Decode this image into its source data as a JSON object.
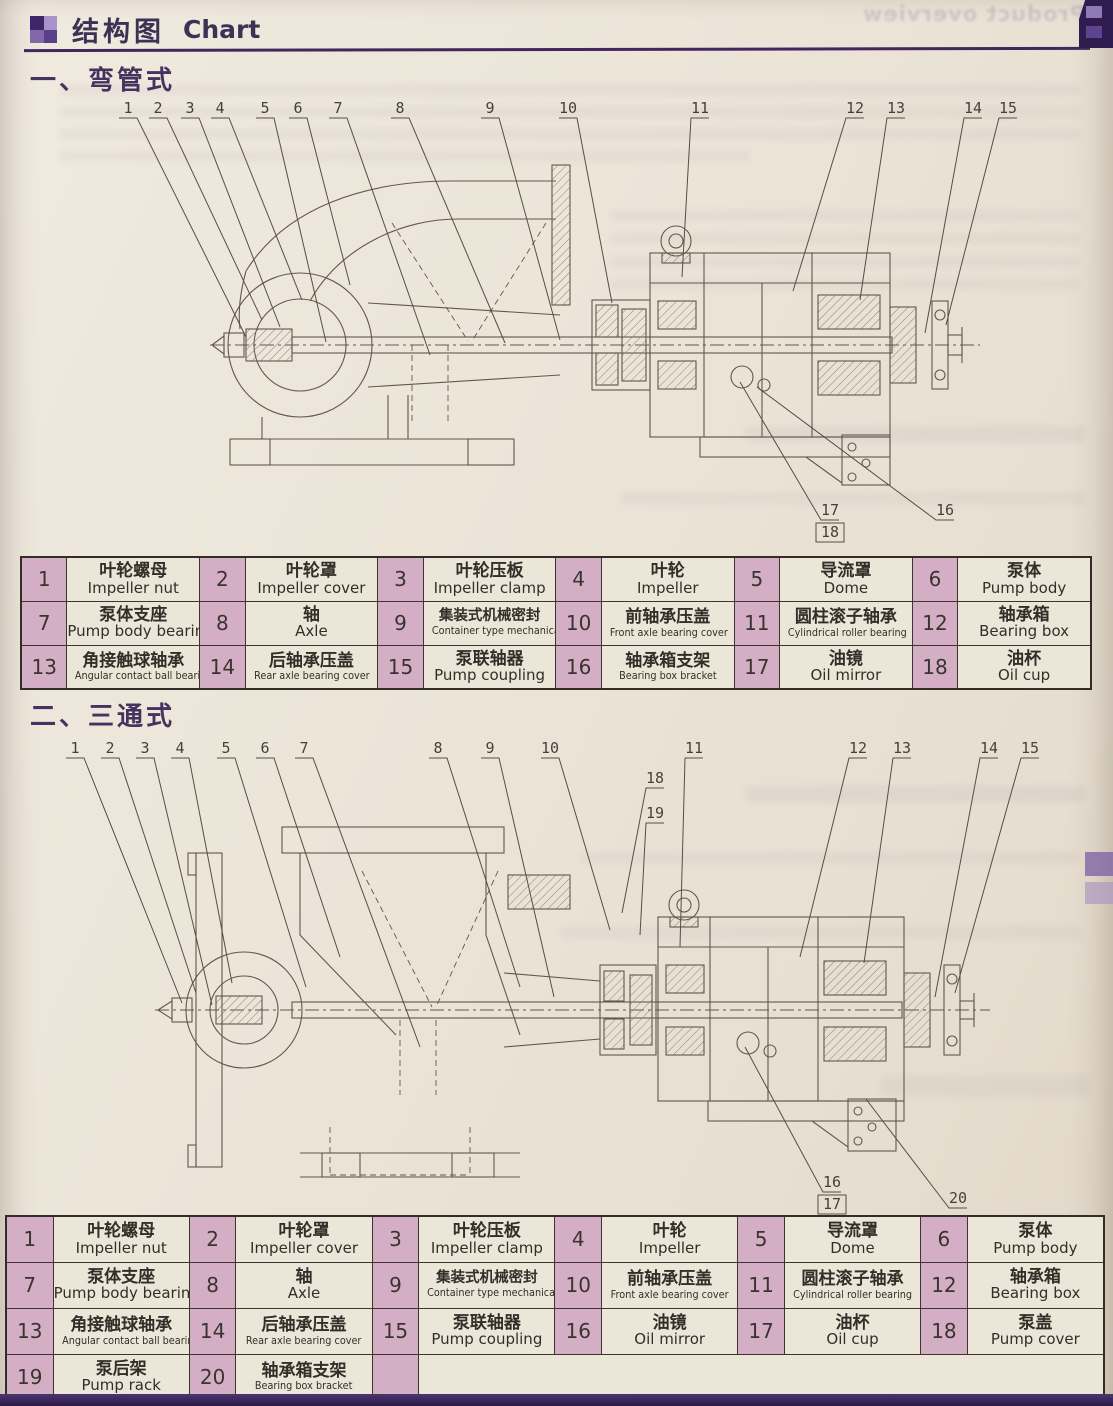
{
  "colors": {
    "heading_purple": "#46325f",
    "rule_purple": "#43265e",
    "table_number_cell_bg": "#d4aec5",
    "table_name_cell_bg": "#ece6d9",
    "table_border": "#3c362f",
    "page_background": "#eae3d6",
    "drawing_line": "#60584b",
    "page_edge_purple": "#33205a"
  },
  "header": {
    "title_zh": "结构图",
    "title_en": "Chart"
  },
  "sections": [
    {
      "heading": "一、弯管式"
    },
    {
      "heading": "二、三通式"
    }
  ],
  "bleedthrough": {
    "top_right": "Product overview"
  },
  "diagrams": [
    {
      "name": "bend-pipe-type-pump-cross-section",
      "callouts": [
        {
          "n": "1",
          "x": 128,
          "tx": 246,
          "ty": 242
        },
        {
          "n": "2",
          "x": 158,
          "tx": 262,
          "ty": 225
        },
        {
          "n": "3",
          "x": 190,
          "tx": 280,
          "ty": 232
        },
        {
          "n": "4",
          "x": 220,
          "tx": 302,
          "ty": 205
        },
        {
          "n": "5",
          "x": 265,
          "tx": 326,
          "ty": 247
        },
        {
          "n": "6",
          "x": 298,
          "tx": 350,
          "ty": 190
        },
        {
          "n": "7",
          "x": 338,
          "tx": 430,
          "ty": 260
        },
        {
          "n": "8",
          "x": 400,
          "tx": 505,
          "ty": 248
        },
        {
          "n": "9",
          "x": 490,
          "tx": 560,
          "ty": 245
        },
        {
          "n": "10",
          "x": 568,
          "tx": 612,
          "ty": 208
        },
        {
          "n": "11",
          "x": 700,
          "tx": 682,
          "ty": 182
        },
        {
          "n": "12",
          "x": 855,
          "tx": 793,
          "ty": 196
        },
        {
          "n": "13",
          "x": 896,
          "tx": 860,
          "ty": 205
        },
        {
          "n": "14",
          "x": 973,
          "tx": 925,
          "ty": 238
        },
        {
          "n": "15",
          "x": 1008,
          "tx": 946,
          "ty": 230
        },
        {
          "n": "17",
          "x": 830,
          "y": 420,
          "tx": 740,
          "ty": 287
        },
        {
          "n": "18",
          "x": 830,
          "y": 442,
          "box": true,
          "noline": true
        },
        {
          "n": "16",
          "x": 945,
          "y": 420,
          "tx": 757,
          "ty": 292
        }
      ]
    },
    {
      "name": "tee-type-pump-cross-section",
      "callouts": [
        {
          "n": "1",
          "x": 75,
          "tx": 182,
          "ty": 268
        },
        {
          "n": "2",
          "x": 110,
          "tx": 196,
          "ty": 258
        },
        {
          "n": "3",
          "x": 145,
          "tx": 212,
          "ty": 270
        },
        {
          "n": "4",
          "x": 180,
          "tx": 232,
          "ty": 248
        },
        {
          "n": "5",
          "x": 226,
          "tx": 306,
          "ty": 252
        },
        {
          "n": "6",
          "x": 265,
          "tx": 340,
          "ty": 222
        },
        {
          "n": "7",
          "x": 304,
          "tx": 420,
          "ty": 312
        },
        {
          "n": "8",
          "x": 438,
          "tx": 520,
          "ty": 252
        },
        {
          "n": "9",
          "x": 490,
          "tx": 554,
          "ty": 262
        },
        {
          "n": "10",
          "x": 550,
          "tx": 610,
          "ty": 195
        },
        {
          "n": "18",
          "x": 655,
          "y": 48,
          "tx": 622,
          "ty": 178
        },
        {
          "n": "19",
          "x": 655,
          "y": 83,
          "tx": 640,
          "ty": 200
        },
        {
          "n": "11",
          "x": 694,
          "tx": 680,
          "ty": 212
        },
        {
          "n": "12",
          "x": 858,
          "tx": 800,
          "ty": 222
        },
        {
          "n": "13",
          "x": 902,
          "tx": 864,
          "ty": 228
        },
        {
          "n": "14",
          "x": 989,
          "tx": 935,
          "ty": 262
        },
        {
          "n": "15",
          "x": 1030,
          "tx": 955,
          "ty": 258
        },
        {
          "n": "16",
          "x": 832,
          "y": 452,
          "tx": 745,
          "ty": 312
        },
        {
          "n": "17",
          "x": 832,
          "y": 474,
          "box": true,
          "noline": true
        },
        {
          "n": "20",
          "x": 958,
          "y": 468,
          "tx": 866,
          "ty": 364
        }
      ]
    }
  ],
  "tables": [
    {
      "rows": [
        [
          {
            "num": "1",
            "zh": "叶轮螺母",
            "en": "Impeller nut"
          },
          {
            "num": "2",
            "zh": "叶轮罩",
            "en": "Impeller cover"
          },
          {
            "num": "3",
            "zh": "叶轮压板",
            "en": "Impeller clamp"
          },
          {
            "num": "4",
            "zh": "叶轮",
            "en": "Impeller"
          },
          {
            "num": "5",
            "zh": "导流罩",
            "en": "Dome"
          },
          {
            "num": "6",
            "zh": "泵体",
            "en": "Pump body"
          }
        ],
        [
          {
            "num": "7",
            "zh": "泵体支座",
            "en": "Pump body bearing"
          },
          {
            "num": "8",
            "zh": "轴",
            "en": "Axle"
          },
          {
            "num": "9",
            "zh": "集装式机械密封",
            "en": "Container type mechanical seal"
          },
          {
            "num": "10",
            "zh": "前轴承压盖",
            "en": "Front axle bearing cover"
          },
          {
            "num": "11",
            "zh": "圆柱滚子轴承",
            "en": "Cylindrical roller bearing"
          },
          {
            "num": "12",
            "zh": "轴承箱",
            "en": "Bearing box"
          }
        ],
        [
          {
            "num": "13",
            "zh": "角接触球轴承",
            "en": "Angular contact ball bearings"
          },
          {
            "num": "14",
            "zh": "后轴承压盖",
            "en": "Rear axle bearing cover"
          },
          {
            "num": "15",
            "zh": "泵联轴器",
            "en": "Pump coupling"
          },
          {
            "num": "16",
            "zh": "轴承箱支架",
            "en": "Bearing box bracket"
          },
          {
            "num": "17",
            "zh": "油镜",
            "en": "Oil mirror"
          },
          {
            "num": "18",
            "zh": "油杯",
            "en": "Oil cup"
          }
        ]
      ]
    },
    {
      "rows": [
        [
          {
            "num": "1",
            "zh": "叶轮螺母",
            "en": "Impeller nut"
          },
          {
            "num": "2",
            "zh": "叶轮罩",
            "en": "Impeller cover"
          },
          {
            "num": "3",
            "zh": "叶轮压板",
            "en": "Impeller clamp"
          },
          {
            "num": "4",
            "zh": "叶轮",
            "en": "Impeller"
          },
          {
            "num": "5",
            "zh": "导流罩",
            "en": "Dome"
          },
          {
            "num": "6",
            "zh": "泵体",
            "en": "Pump body"
          }
        ],
        [
          {
            "num": "7",
            "zh": "泵体支座",
            "en": "Pump body bearing"
          },
          {
            "num": "8",
            "zh": "轴",
            "en": "Axle"
          },
          {
            "num": "9",
            "zh": "集装式机械密封",
            "en": "Container type mechanical seal"
          },
          {
            "num": "10",
            "zh": "前轴承压盖",
            "en": "Front axle bearing cover"
          },
          {
            "num": "11",
            "zh": "圆柱滚子轴承",
            "en": "Cylindrical roller bearing"
          },
          {
            "num": "12",
            "zh": "轴承箱",
            "en": "Bearing box"
          }
        ],
        [
          {
            "num": "13",
            "zh": "角接触球轴承",
            "en": "Angular contact ball bearings"
          },
          {
            "num": "14",
            "zh": "后轴承压盖",
            "en": "Rear axle bearing cover"
          },
          {
            "num": "15",
            "zh": "泵联轴器",
            "en": "Pump coupling"
          },
          {
            "num": "16",
            "zh": "油镜",
            "en": "Oil mirror"
          },
          {
            "num": "17",
            "zh": "油杯",
            "en": "Oil cup"
          },
          {
            "num": "18",
            "zh": "泵盖",
            "en": "Pump cover"
          }
        ],
        [
          {
            "num": "19",
            "zh": "泵后架",
            "en": "Pump rack"
          },
          {
            "num": "20",
            "zh": "轴承箱支架",
            "en": "Bearing box bracket"
          },
          {
            "num": "",
            "zh": "",
            "en": "",
            "span": 7
          }
        ]
      ]
    }
  ]
}
